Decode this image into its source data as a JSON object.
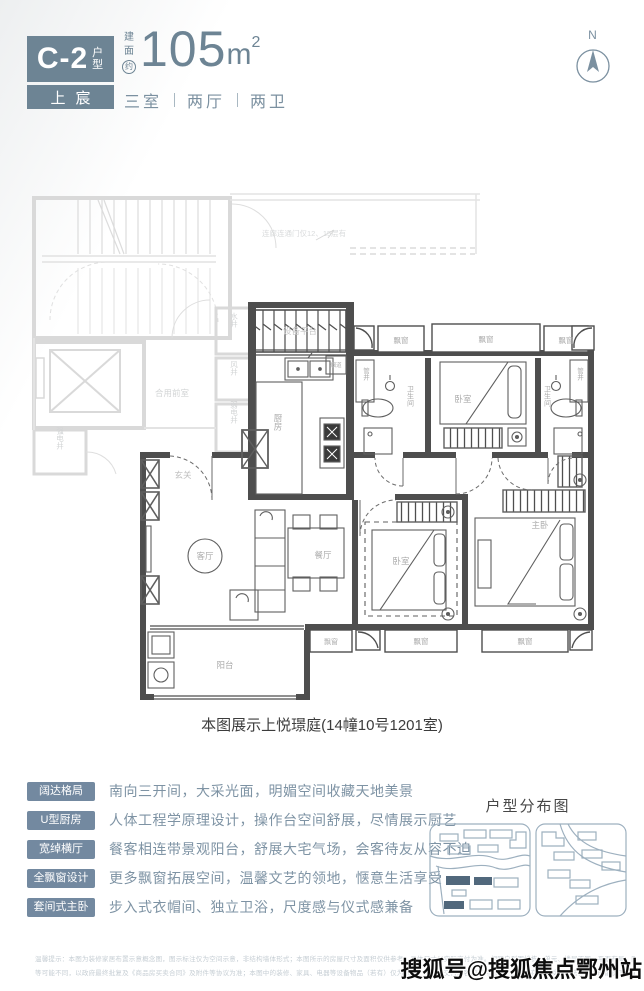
{
  "header": {
    "unit_code": "C-2",
    "unit_type": "户型",
    "brand": "上宸",
    "area_prefix": [
      "建",
      "面",
      "约"
    ],
    "area_value": "105",
    "area_unit": "m",
    "area_sup": "2",
    "spec": [
      "三室",
      "两厅",
      "两卫"
    ],
    "compass": "N"
  },
  "plan": {
    "corridor_note": "连廊连通门仅12、15层有",
    "caption": "本图展示上悦璟庭(14幢10号1201室)",
    "rooms": {
      "shared_lobby": "合用前室",
      "water_shaft": "水井",
      "air_shaft": "风井",
      "weak_shaft": "弱电井",
      "strong_shaft": "强电井",
      "equip_platform": "设备平台",
      "kitchen": "厨房",
      "flue": "烟道",
      "pipe_shaft": "管井",
      "bath": "卫生间",
      "bedroom": "卧室",
      "master": "主卧",
      "living": "客厅",
      "dining": "餐厅",
      "balcony": "阳台",
      "bay": "飘窗",
      "entry": "玄关"
    }
  },
  "features": {
    "items": [
      {
        "label": "阔达格局",
        "text": "南向三开间，大采光面，明媚空间收藏天地美景"
      },
      {
        "label": "U型厨房",
        "text": "人体工程学原理设计，操作台空间舒展，尽情展示厨艺"
      },
      {
        "label": "宽绰横厅",
        "text": "餐客相连带景观阳台，舒展大宅气场，会客待友从容不迫"
      },
      {
        "label": "全飘窗设计",
        "text": "更多飘窗拓展空间，温馨文艺的领地，惬意生活享受"
      },
      {
        "label": "套间式主卧",
        "text": "步入式衣帽间、独立卫浴，尺度感与仪式感兼备"
      }
    ]
  },
  "distribution": {
    "title": "户型分布图"
  },
  "disclaimer": {
    "line1": "温馨提示：本图为装修家居布置示意概念图，图示标注仅为空间示意，非结构墙体形式；本图所示的房屋尺寸及面积仅供参考，具体尺寸以实际交付为准。相同户型因楼栋、单元、楼层不同，平面布局、阳台、窗台、飘窗、管井位置、外立面、设备平台",
    "line2": "等可能不同，以政府最终批复及《商品房买卖合同》及附件等协议为准；本图中的装修、家具、电器等设备物品（若有）仅为示意，不作为交付内容和交付标准。出卖人在不违反国家法律法规的前提下保留对本图的解释权。"
  },
  "watermark": {
    "text": "搜狐号@搜狐焦点鄂州站"
  }
}
